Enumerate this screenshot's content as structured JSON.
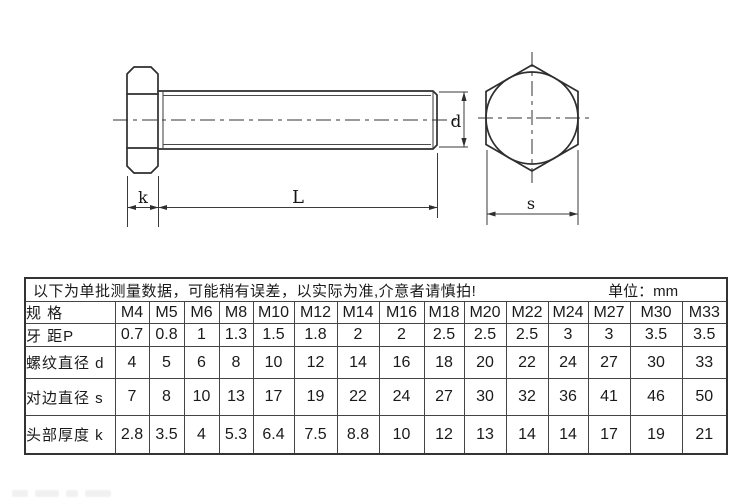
{
  "drawing": {
    "labels": {
      "k": "k",
      "L": "L",
      "d": "d",
      "s": "s"
    }
  },
  "table": {
    "note": "以下为单批测量数据，可能稍有误差，以实际为准,介意者请慎拍!",
    "unit": "单位：mm",
    "row_headers": [
      "规 格",
      "牙 距P",
      "螺纹直径 d",
      "对边直径 s",
      "头部厚度 k"
    ],
    "specs": [
      "M4",
      "M5",
      "M6",
      "M8",
      "M10",
      "M12",
      "M14",
      "M16",
      "M18",
      "M20",
      "M22",
      "M24",
      "M27",
      "M30",
      "M33"
    ],
    "pitch": [
      "0.7",
      "0.8",
      "1",
      "1.3",
      "1.5",
      "1.8",
      "2",
      "2",
      "2.5",
      "2.5",
      "2.5",
      "3",
      "3",
      "3.5",
      "3.5"
    ],
    "thread_diameter": [
      "4",
      "5",
      "6",
      "8",
      "10",
      "12",
      "14",
      "16",
      "18",
      "20",
      "22",
      "24",
      "27",
      "30",
      "33"
    ],
    "across_flats": [
      "7",
      "8",
      "10",
      "13",
      "17",
      "19",
      "22",
      "24",
      "27",
      "30",
      "32",
      "36",
      "41",
      "46",
      "50"
    ],
    "head_thickness": [
      "2.8",
      "3.5",
      "4",
      "5.3",
      "6.4",
      "7.5",
      "8.8",
      "10",
      "12",
      "13",
      "14",
      "14",
      "17",
      "19",
      "21"
    ]
  }
}
